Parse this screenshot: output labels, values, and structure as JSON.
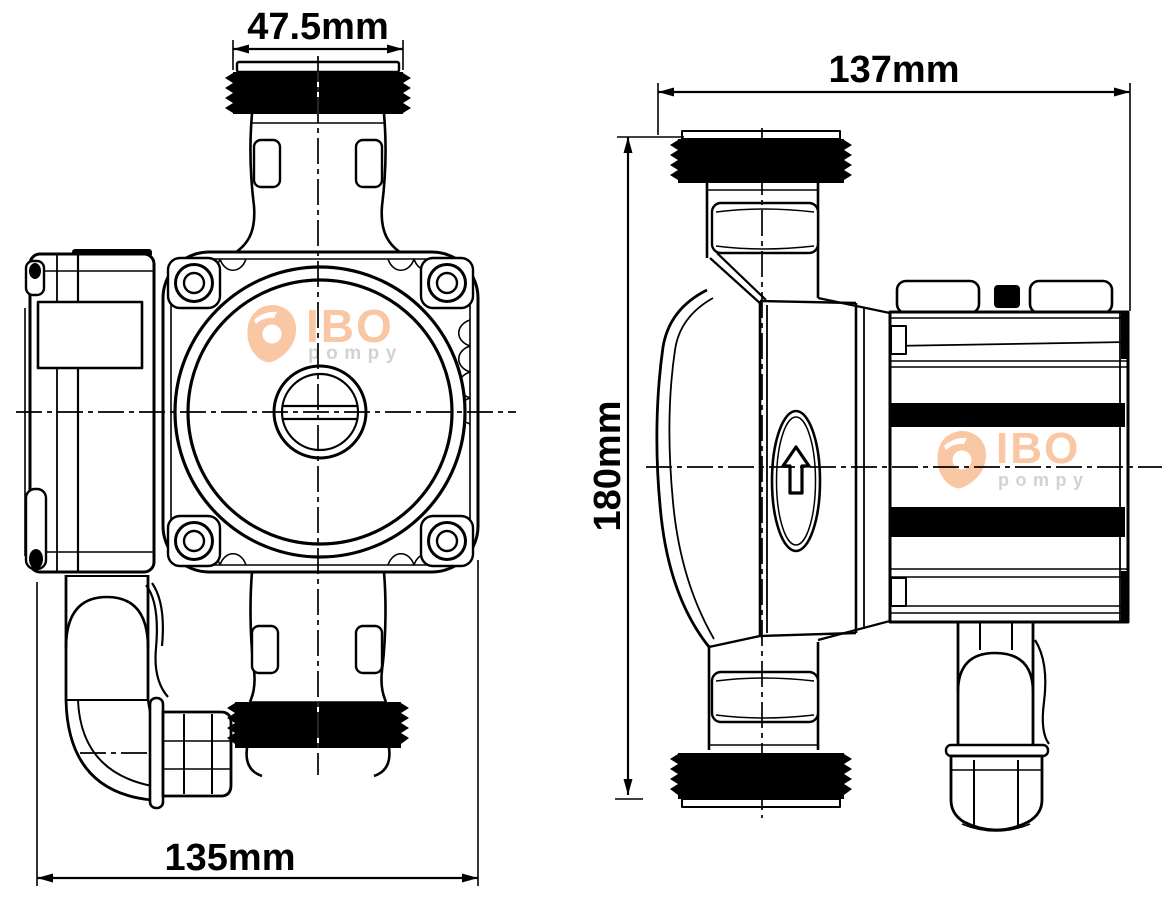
{
  "drawing": {
    "background": "#ffffff",
    "line_color": "#000000",
    "thread_fill": "#000000"
  },
  "views": {
    "front": {
      "dim_top": "47.5mm",
      "dim_bottom": "135mm"
    },
    "side": {
      "dim_top": "137mm",
      "dim_height": "180mm"
    }
  },
  "logo": {
    "brand": "IBO",
    "subtitle": "pompy",
    "brand_color": "#f9c7a4",
    "subtitle_color": "#d2d2d2"
  },
  "icons": {
    "flow_direction": "up-arrow"
  }
}
